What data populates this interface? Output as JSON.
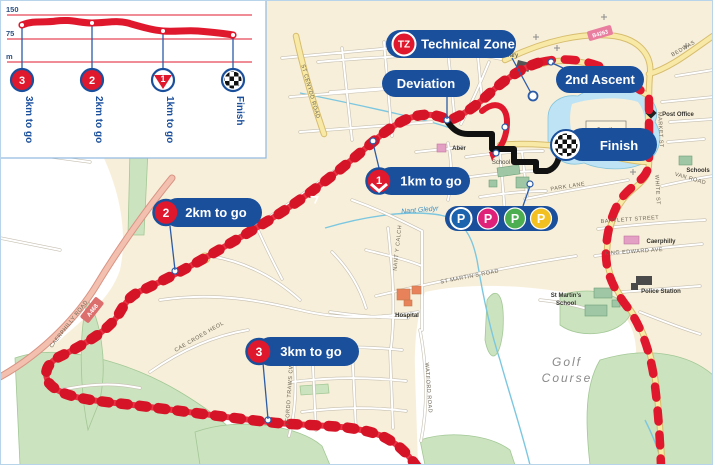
{
  "profile": {
    "yticks": [
      "150",
      "75",
      "m"
    ],
    "markers": [
      {
        "num": "3",
        "label": "3km to go"
      },
      {
        "num": "2",
        "label": "2km to go"
      },
      {
        "num": "1",
        "label": "1km to go"
      },
      {
        "num": "",
        "label": "Finish"
      }
    ]
  },
  "chart_data": {
    "type": "area",
    "title": "Finish elevation profile",
    "x": [
      "3km to go",
      "2km to go",
      "1km to go",
      "Finish"
    ],
    "elevation_m": [
      96,
      97,
      85,
      80
    ],
    "ylabel": "m",
    "yticks": [
      150,
      75
    ],
    "ylim": [
      0,
      150
    ],
    "grid": "horizontal red lines",
    "legend": "none"
  },
  "callouts": {
    "tz_abbr": "TZ",
    "technical_zone": "Technical Zone",
    "deviation": "Deviation",
    "second_ascent": "2nd Ascent",
    "finish": "Finish",
    "km1": "1km to go",
    "km1_num": "1",
    "km2": "2km to go",
    "km2_num": "2",
    "km3": "3km to go",
    "km3_num": "3"
  },
  "parking": {
    "p1": "P",
    "p2": "P",
    "p3": "P",
    "p4": "P"
  },
  "places": {
    "library": "library",
    "castle": "Castle",
    "school": "School",
    "aber": "Aber",
    "hospital": "Hospital",
    "post_office": "Post Office",
    "schools": "Schools",
    "station": "Caerphilly",
    "police": "Police Station",
    "st_martins_1": "St Martin's",
    "st_martins_2": "School",
    "golf_1": "Golf",
    "golf_2": "Course",
    "stream": "Nant Gledyr"
  },
  "roads": {
    "a468": "A468",
    "b4263": "B4263",
    "caerphilly_road": "CAERPHILLY ROAD",
    "st_cenydd": "ST CENYDD ROAD",
    "cae_croes_heol": "CAE CROES HEOL",
    "ffordd_traws_cwm": "FFORDD TRAWS CWM",
    "watford": "WATFORD ROAD",
    "nant_y_calch": "NANT Y CALCH",
    "st_martins_road": "ST MARTIN'S ROAD",
    "park_lane": "PARK LANE",
    "market_st": "MARKET ST",
    "white_st": "WHITE ST",
    "bartlett": "BARTLETT STREET",
    "king_edward": "KING EDWARD AVE",
    "van_road": "VAN ROAD",
    "bedwas": "BEDWAS"
  },
  "colors": {
    "route_red": "#e0182d",
    "deviation_black": "#111111",
    "pill_blue": "#1a4f9c",
    "water": "#bee3f4",
    "urban": "#f8efda",
    "p_blue": "#1b63ac",
    "p_pink": "#e0217a",
    "p_green": "#4cae50",
    "p_yellow": "#f2c021"
  }
}
